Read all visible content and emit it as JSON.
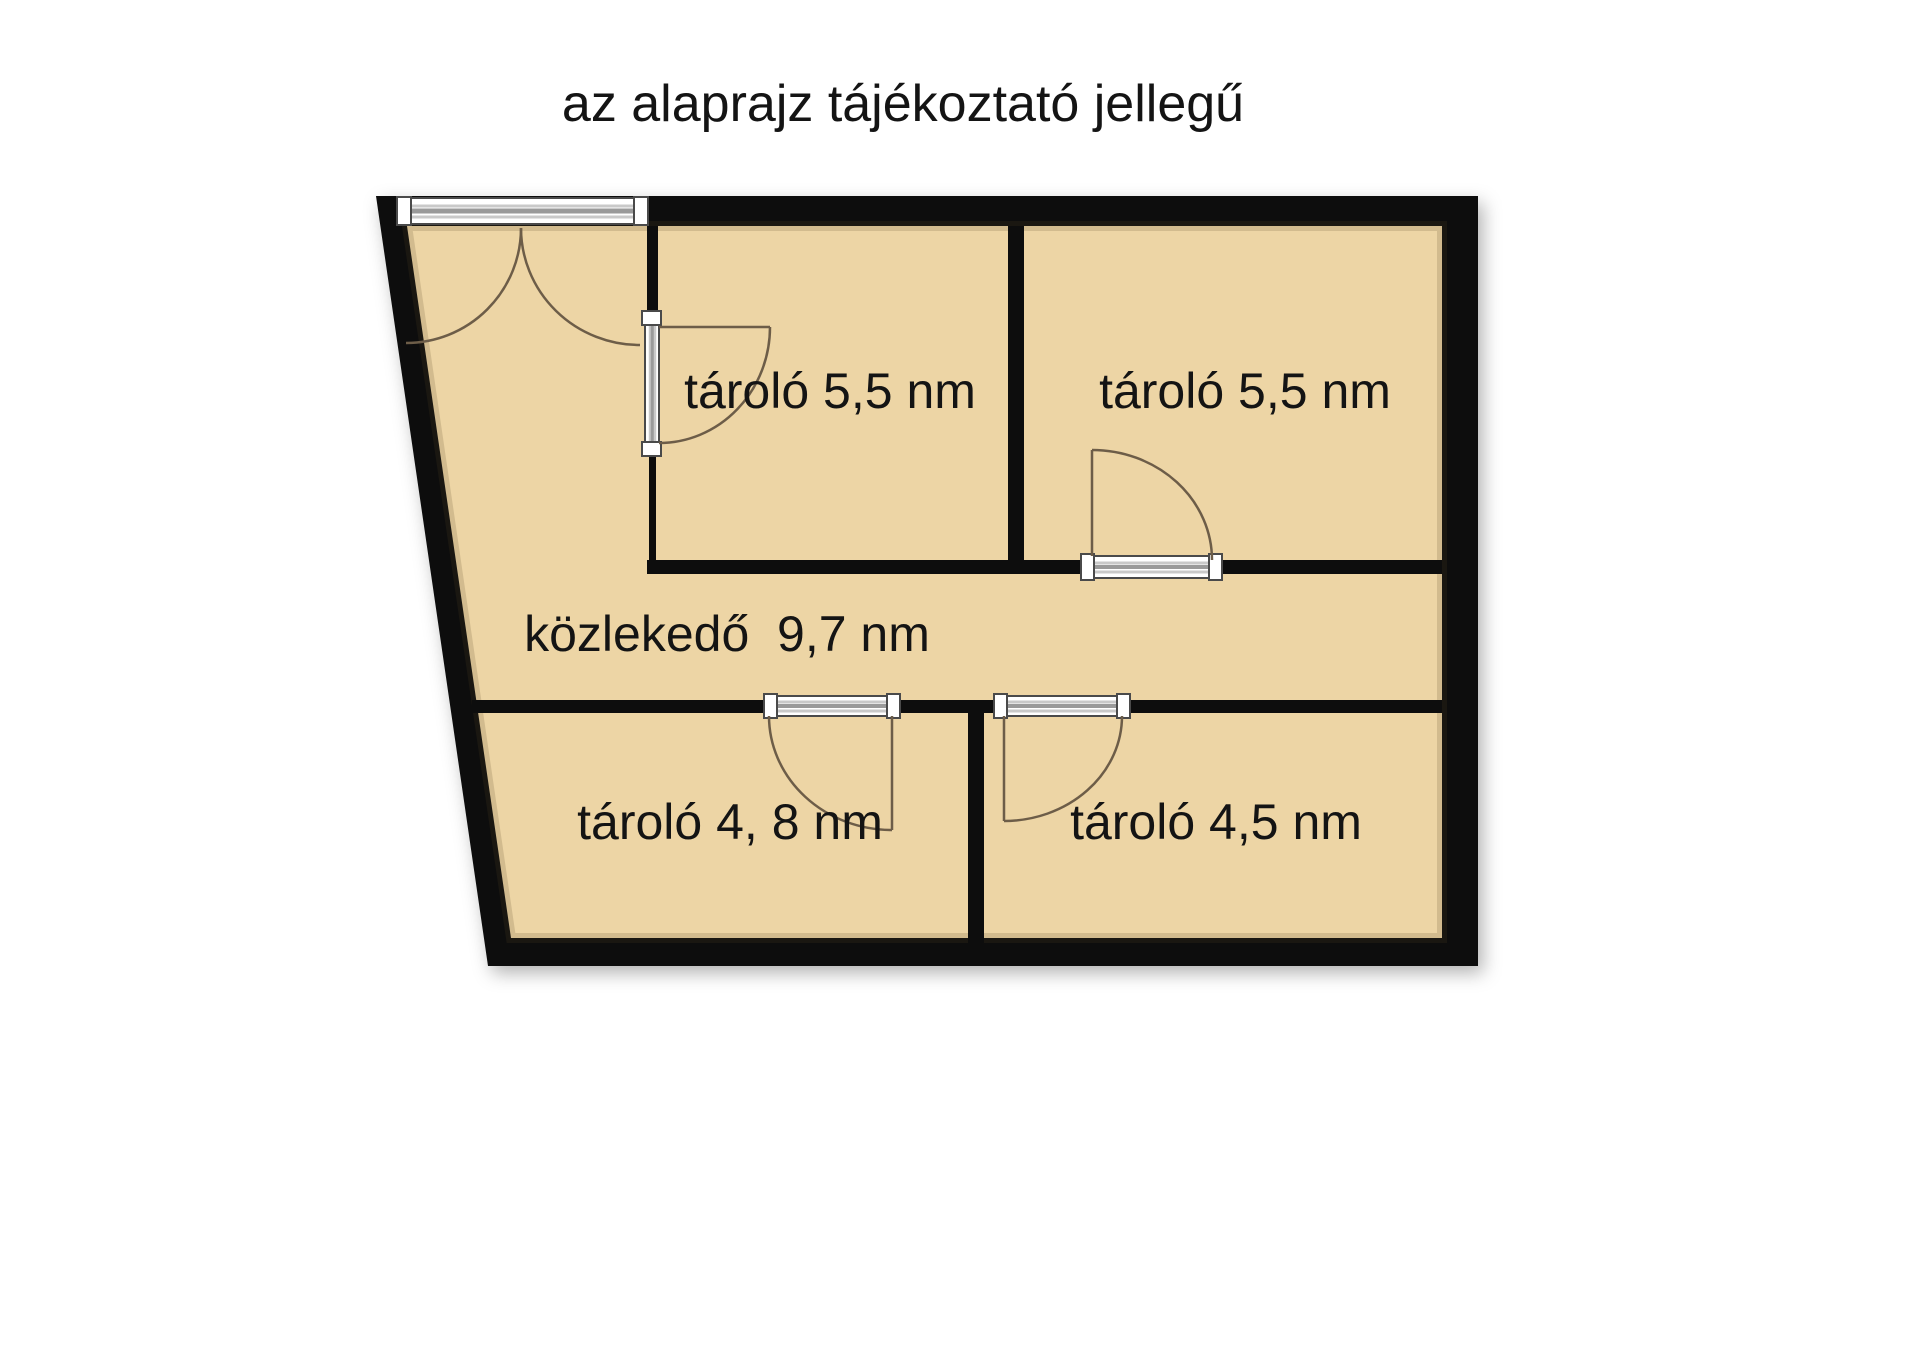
{
  "title": "az alaprajz tájékoztató jellegű",
  "floor_plan": {
    "rooms": [
      {
        "name": "tároló",
        "area": "5,5 nm",
        "label": "tároló 5,5 nm"
      },
      {
        "name": "tároló",
        "area": "5,5 nm",
        "label": "tároló 5,5 nm"
      },
      {
        "name": "közlekedő",
        "area": "9,7 nm",
        "label": "közlekedő  9,7 nm"
      },
      {
        "name": "tároló",
        "area": "4, 8 nm",
        "label": "tároló 4, 8 nm"
      },
      {
        "name": "tároló",
        "area": "4,5 nm",
        "label": "tároló 4,5 nm"
      }
    ],
    "colors": {
      "room_fill": "#edd5a5",
      "wall": "#0d0d0d",
      "door_swing": "#6d5d48",
      "door_frame_fill": "#ffffff",
      "door_frame_stripe": "#9a9a9a",
      "door_frame_outline": "#4a4a4a",
      "text": "#141414",
      "background": "#ffffff"
    }
  }
}
